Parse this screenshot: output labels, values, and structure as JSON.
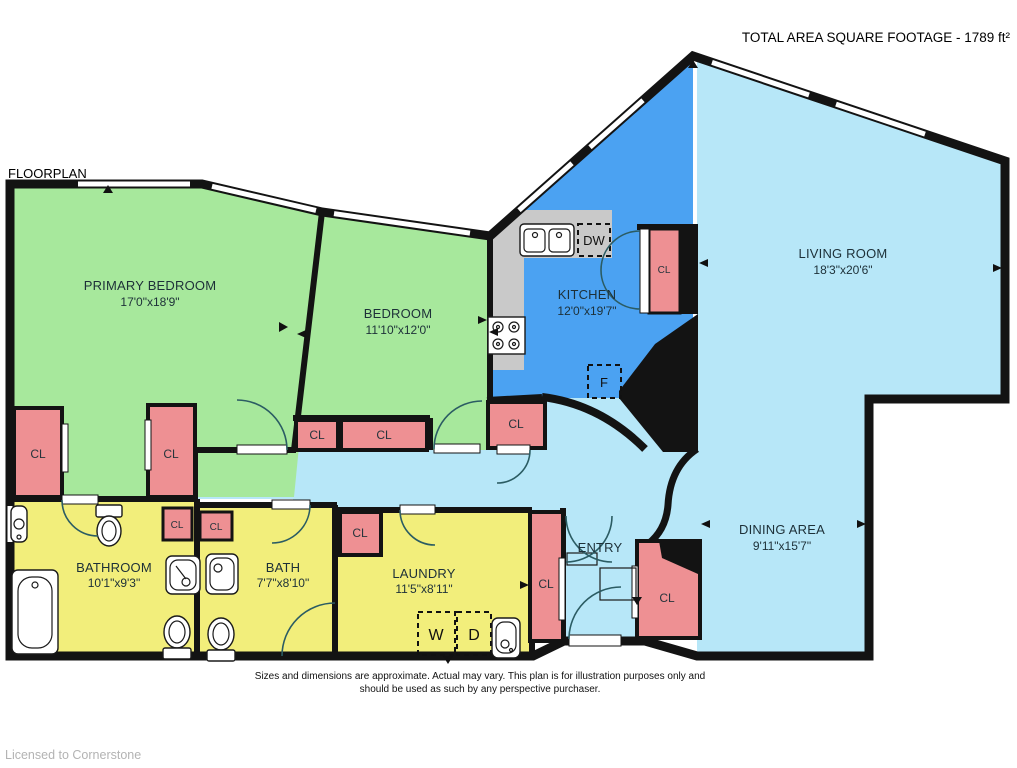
{
  "header": {
    "title": "TOTAL AREA SQUARE FOOTAGE - 1789 ft²",
    "plan_label": "FLOORPLAN"
  },
  "rooms": {
    "primary_bedroom": {
      "name": "PRIMARY BEDROOM",
      "dims": "17'0\"x18'9\""
    },
    "bedroom": {
      "name": "BEDROOM",
      "dims": "11'10\"x12'0\""
    },
    "kitchen": {
      "name": "KITCHEN",
      "dims": "12'0\"x19'7\""
    },
    "living_room": {
      "name": "LIVING ROOM",
      "dims": "18'3\"x20'6\""
    },
    "dining_area": {
      "name": "DINING AREA",
      "dims": "9'11\"x15'7\""
    },
    "bathroom": {
      "name": "BATHROOM",
      "dims": "10'1\"x9'3\""
    },
    "bath": {
      "name": "BATH",
      "dims": "7'7\"x8'10\""
    },
    "laundry": {
      "name": "LAUNDRY",
      "dims": "11'5\"x8'11\""
    },
    "entry": {
      "name": "ENTRY"
    }
  },
  "labels": {
    "closet": "CL",
    "dishwasher": "DW",
    "fridge": "F",
    "washer": "W",
    "dryer": "D"
  },
  "footer": {
    "disclaimer_line1": "Sizes and dimensions are approximate. Actual may vary. This plan is for illustration purposes only and",
    "disclaimer_line2": "should be used as such by any perspective purchaser.",
    "license": "Licensed to Cornerstone"
  },
  "colors": {
    "bedroom_green": "#a7e89c",
    "kitchen_blue": "#4ba2f2",
    "living_blue": "#b7e7f8",
    "bath_yellow": "#f2ee7b",
    "closet_pink": "#ee9093",
    "counter_gray": "#c9c9c9",
    "wall_black": "#131313"
  }
}
